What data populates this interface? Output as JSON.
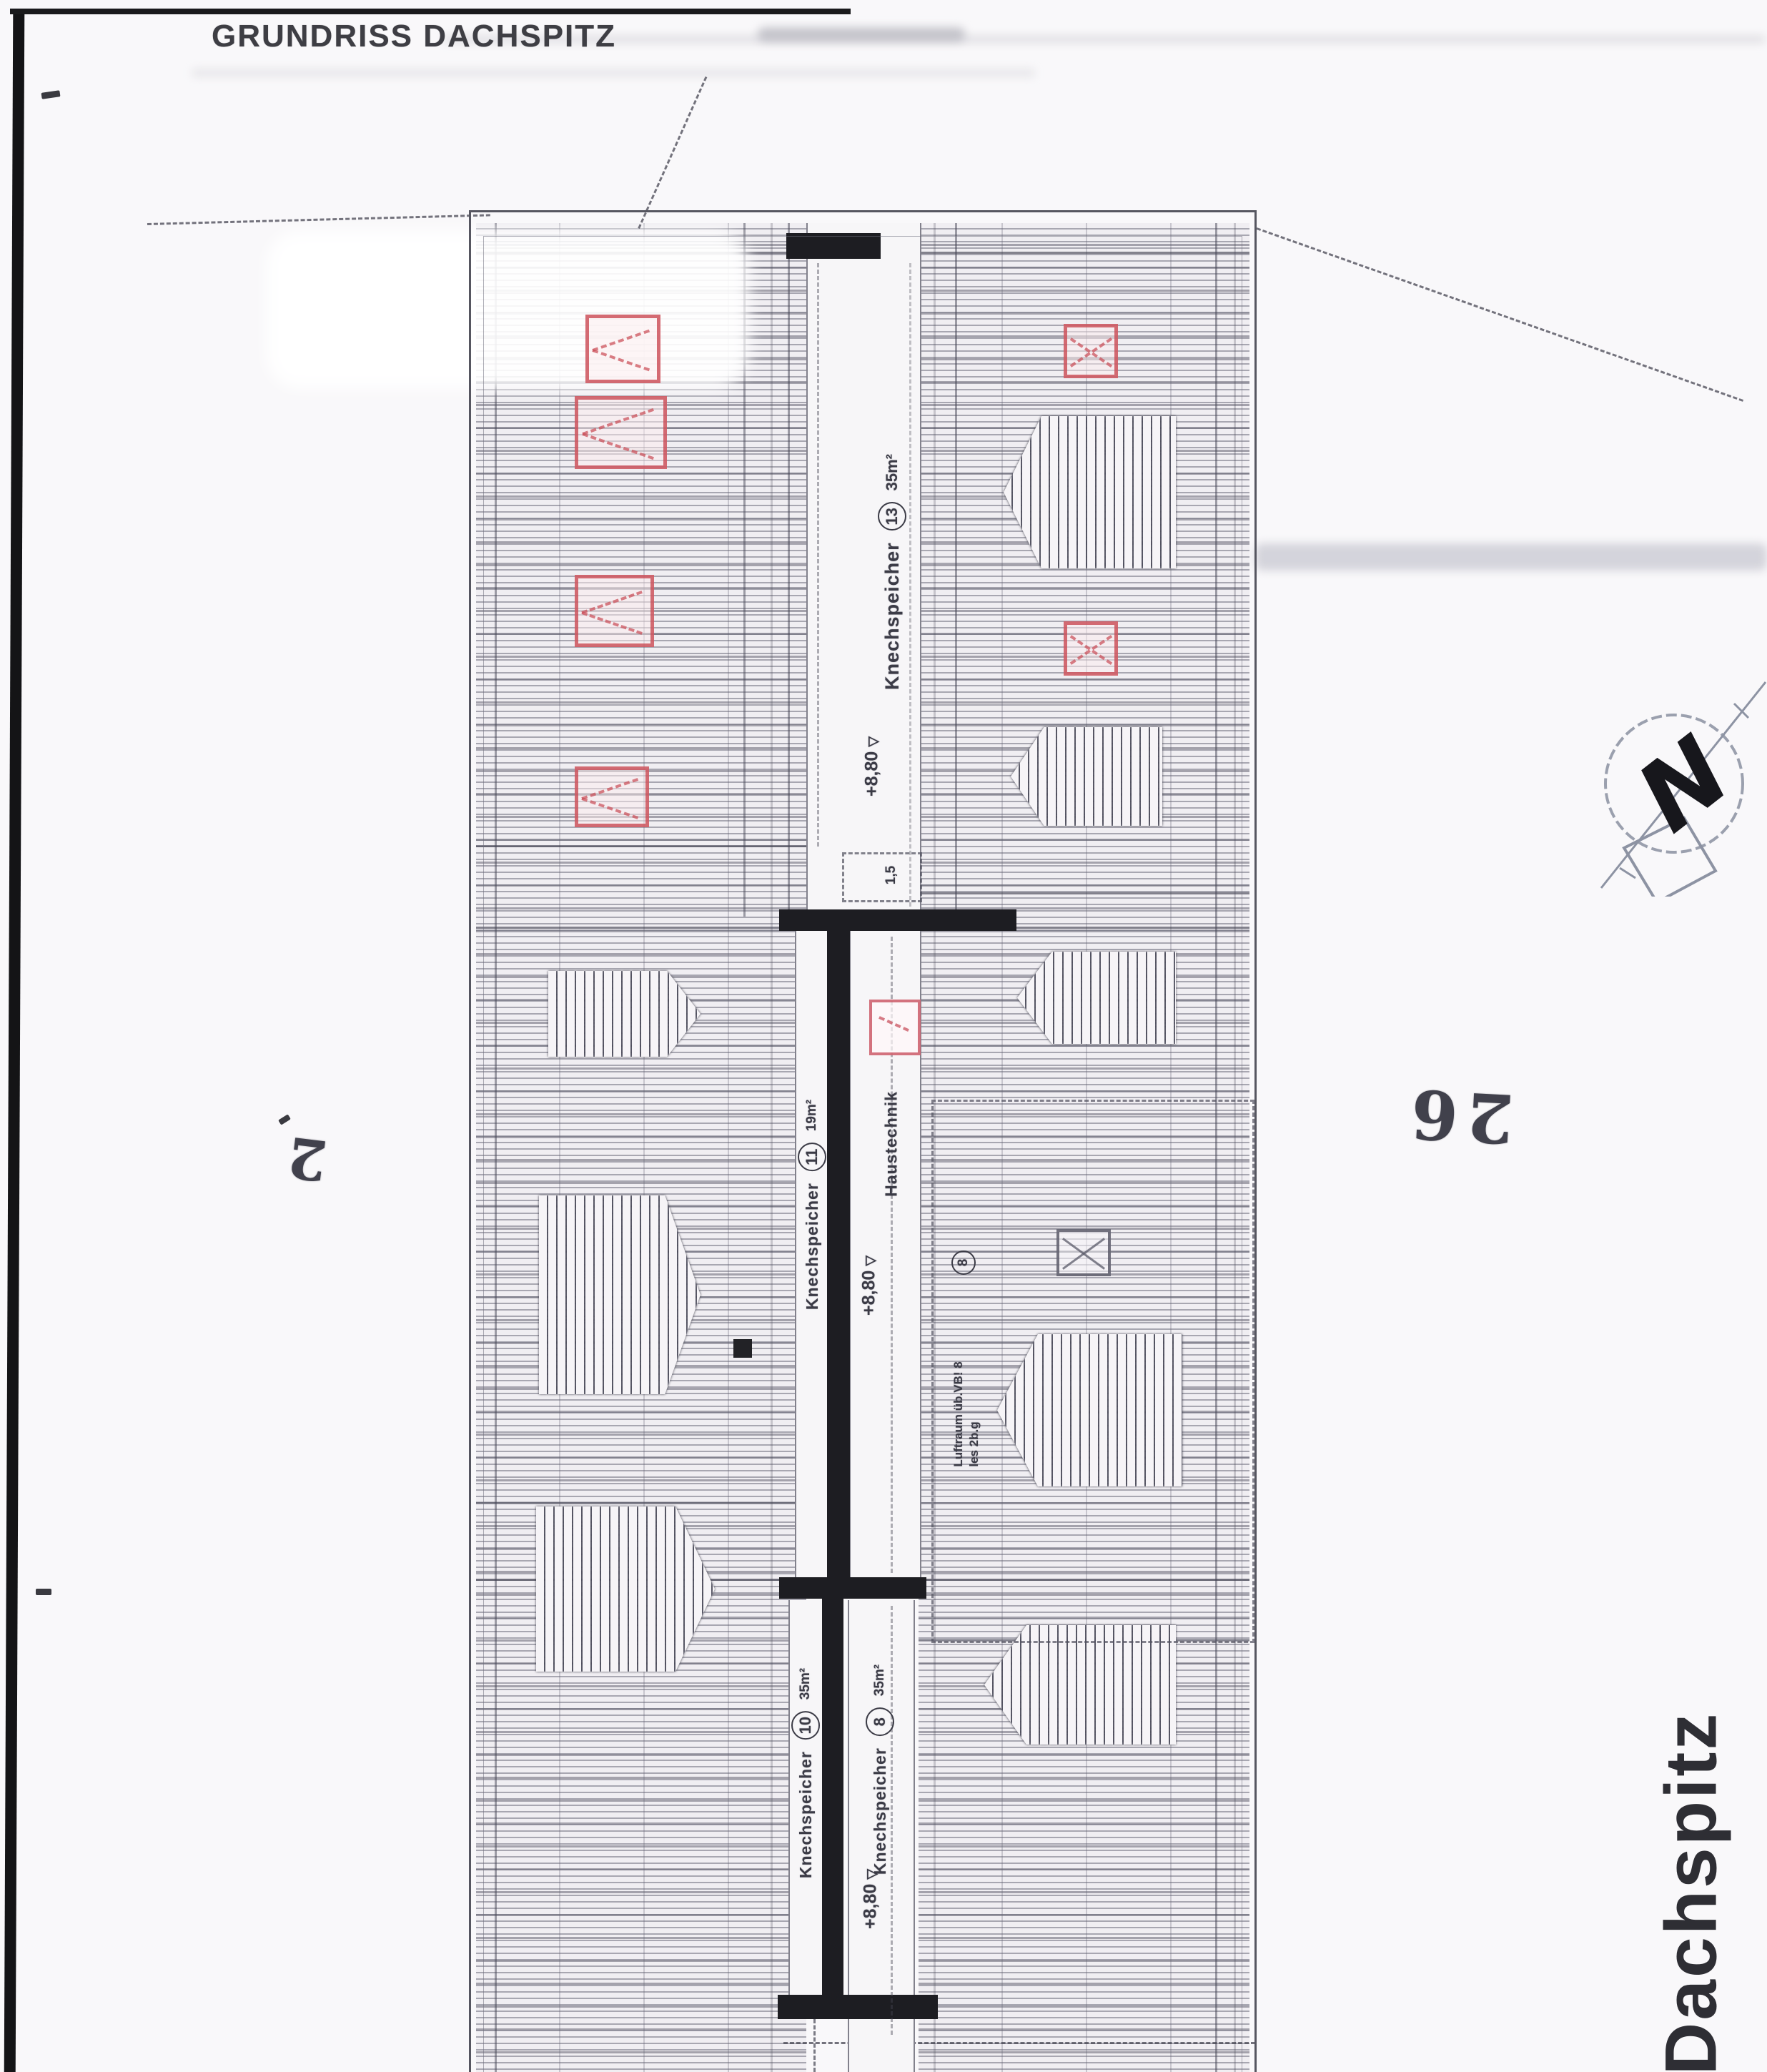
{
  "page": {
    "title": "GRUNDRISS DACHSPITZ",
    "sheet_label": "Dachspitz",
    "handwritten": {
      "right_number": "26",
      "left_number": "2"
    },
    "north": {
      "letter": "N"
    }
  },
  "plan": {
    "rooms": [
      {
        "name": "Knechspeicher",
        "number": "13",
        "area": "35m²"
      },
      {
        "name": "Knechspeicher",
        "number": "11",
        "area": "19m²"
      },
      {
        "name": "Haustechnik",
        "number": "",
        "area": ""
      },
      {
        "name": "Knechspeicher",
        "number": "10",
        "area": "35m²"
      },
      {
        "name": "Knechspeicher",
        "number": "8",
        "area": "35m²"
      }
    ],
    "levels": [
      {
        "value": "+8,80"
      },
      {
        "value": "+8,80"
      },
      {
        "value": "+8,80"
      }
    ],
    "level_symbol": "▽",
    "annotations": {
      "roof_marker_number": "8",
      "junction_note": "1,5",
      "luftraum_line1": "Luftraum üb.VB! 8",
      "luftraum_line2": "les 2b.g"
    },
    "colors": {
      "window_red": "#c94853",
      "wall_black": "#1d1d22",
      "hatch_gray": "#6a6a78"
    }
  }
}
